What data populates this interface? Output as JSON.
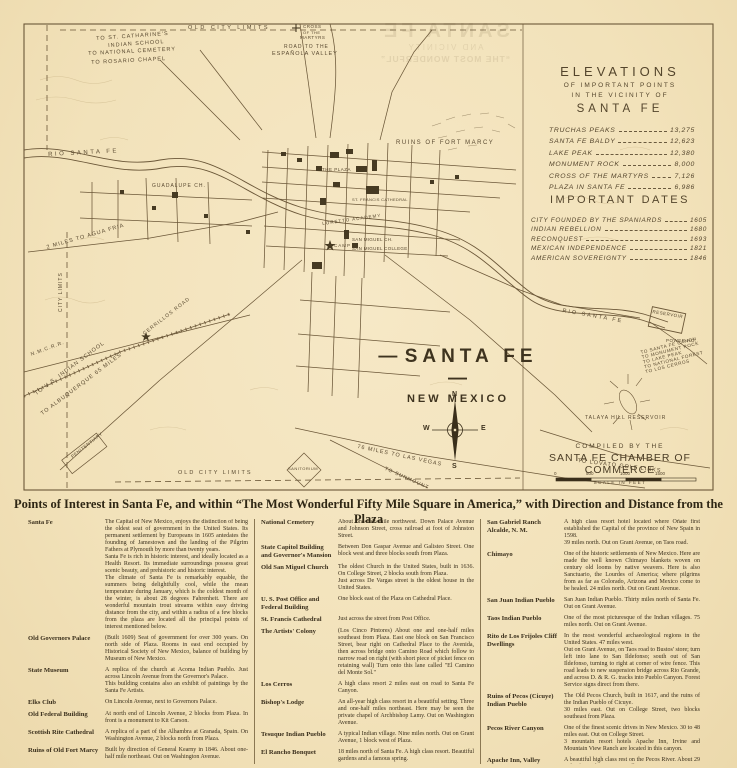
{
  "map": {
    "title": "SANTA FE",
    "subtitle": "NEW MEXICO",
    "compiled_by_line1": "COMPILED BY THE",
    "compiled_by_line2": "SANTA FE CHAMBER OF COMMERCE",
    "scale_label": "SCALE IN FEET",
    "scale_ticks": [
      "0",
      "500",
      "1000",
      "1500"
    ],
    "compass": {
      "n": "N",
      "s": "S",
      "e": "E",
      "w": "W"
    },
    "labels": [
      {
        "text": "OLD CITY LIMITS"
      },
      {
        "text": "TO ST. CATHARINE'S"
      },
      {
        "text": "INDIAN SCHOOL"
      },
      {
        "text": "TO NATIONAL CEMETERY"
      },
      {
        "text": "TO ROSARIO CHAPEL"
      },
      {
        "text": "ROAD TO THE"
      },
      {
        "text": "ESPAÑOLA VALLEY"
      },
      {
        "text": "CROSS"
      },
      {
        "text": "OF THE"
      },
      {
        "text": "MARTYRS"
      },
      {
        "text": "RUINS OF FORT MARCY"
      },
      {
        "text": "RIO SANTA FE"
      },
      {
        "text": "RIO SANTA FE"
      },
      {
        "text": "GUADALUPE CH."
      },
      {
        "text": "THE PLAZA"
      },
      {
        "text": "ST. FRANCIS CATHEDRAL"
      },
      {
        "text": "SAN MIGUEL CH."
      },
      {
        "text": "SAN MIGUEL COLLEGE"
      },
      {
        "text": "LORETTO ACADEMY"
      },
      {
        "text": "2 MILES TO AGUA FRIA"
      },
      {
        "text": "CITY LIMITS"
      },
      {
        "text": "N.M.C.R.R."
      },
      {
        "text": "TO U.S. INDIAN SCHOOL"
      },
      {
        "text": "TO ALBUQUERQUE 65 MILES"
      },
      {
        "text": "CERRILLOS ROAD"
      },
      {
        "text": "PENITENTIARY"
      },
      {
        "text": "TO LOVATO GOLF LINKS"
      },
      {
        "text": "OLD CITY LIMITS"
      },
      {
        "text": "76 MILES TO LAS VEGAS"
      },
      {
        "text": "TO SUNMOUNT"
      },
      {
        "text": "SANITORIUM"
      },
      {
        "text": "RESERVOIR"
      },
      {
        "text": "POWER HO."
      },
      {
        "text": "TO SANTA FE CANON"
      },
      {
        "text": "TO MONUMENT ROCK"
      },
      {
        "text": "TO LAKE PEAK"
      },
      {
        "text": "TO NATIONAL FOREST"
      },
      {
        "text": "TO LOS CERROS"
      },
      {
        "text": "TALAYA HILL RESERVOIR"
      },
      {
        "text": "CAMP"
      }
    ],
    "ink_color": "#5a4a31",
    "paper_color": "#f2e2ba"
  },
  "bleedthrough": {
    "line1": "SANTA FE",
    "line2": "AND VICINITY",
    "line3": "“THE MOST WONDERFUL”"
  },
  "elevations": {
    "title": "ELEVATIONS",
    "subtitle1": "OF IMPORTANT POINTS",
    "subtitle2": "IN THE VICINITY OF",
    "subtitle3": "SANTA FE",
    "items": [
      {
        "name": "TRUCHAS PEAKS",
        "value": "13,275"
      },
      {
        "name": "SANTA FE BALDY",
        "value": "12,623"
      },
      {
        "name": "LAKE PEAK",
        "value": "12,380"
      },
      {
        "name": "MONUMENT ROCK",
        "value": "8,000"
      },
      {
        "name": "CROSS OF THE MARTYRS",
        "value": "7,126"
      },
      {
        "name": "PLAZA IN SANTA FE",
        "value": "6,986"
      }
    ]
  },
  "dates": {
    "title": "IMPORTANT DATES",
    "items": [
      {
        "name": "CITY FOUNDED BY THE SPANIARDS",
        "value": "1605"
      },
      {
        "name": "INDIAN REBELLION",
        "value": "1680"
      },
      {
        "name": "RECONQUEST",
        "value": "1693"
      },
      {
        "name": "MEXICAN INDEPENDENCE",
        "value": "1821"
      },
      {
        "name": "AMERICAN SOVEREIGNTY",
        "value": "1846"
      }
    ]
  },
  "poi": {
    "header": "Points of Interest in Santa Fe, and within “The Most Wonderful Fifty Mile Square in America,” with Direction and Distance from the Plaza",
    "columns": [
      {
        "entries": [
          {
            "term": "Santa Fe",
            "desc": "The Capital of New Mexico, enjoys the distinction of being the oldest seat of government in the United States. Its permanent settlement by Europeans in 1605 antedates the founding of Jamestown and the landing of the Pilgrim Fathers at Plymouth by more than twenty years.\nSanta Fe is rich in historic interest, and ideally located as a Health Resort. Its immediate surroundings possess great scenic beauty, and prehistoric and historic interest.\nThe climate of Santa Fe is remarkably equable, the summers being delightfully cool, while the mean temperature during January, which is the coldest month of the winter, is about 28 degrees Fahrenheit. There are wonderful mountain trout streams within easy driving distance from the city, and within a radius of a few blocks from the plaza are located all the principal points of interest mentioned below."
          },
          {
            "term": "Old Governors Palace",
            "desc": "(Built 1609) Seat of government for over 300 years. On north side of Plaza. Rooms in east end occupied by Historical Society of New Mexico, balance of building by Museum of New Mexico."
          },
          {
            "term": "State Museum",
            "desc": "A replica of the church at Acoma Indian Pueblo. Just across Lincoln Avenue from the Governor's Palace.\nThis building contains also an exhibit of paintings by the Santa Fe Artists."
          },
          {
            "term": "Elks Club",
            "desc": "On Lincoln Avenue, next to Governors Palace."
          },
          {
            "term": "Old Federal Building",
            "desc": "At north end of Lincoln Avenue, 2 blocks from Plaza. In front is a monument to Kit Carson."
          },
          {
            "term": "Scottish Rite Cathedral",
            "desc": "A replica of a part of the Alhambra at Granada, Spain. On Washington Avenue, 2 blocks north from Plaza."
          },
          {
            "term": "Ruins of Old Fort Marcy",
            "desc": "Built by direction of General Kearny in 1846. About one-half mile northeast. Out on Washington Avenue."
          }
        ]
      },
      {
        "entries": [
          {
            "term": "National Cemetery",
            "desc": "About one-half mile northwest. Down Palace Avenue and Johnson Street, cross railroad at foot of Johnston Street."
          },
          {
            "term": "State Capitol Building and Governor's Mansion",
            "desc": "Between Don Gaspar Avenue and Galisteo Street. One block west and three blocks south from Plaza."
          },
          {
            "term": "Old San Miguel Church",
            "desc": "The oldest Church in the United States, built in 1636. On College Street, 2 blocks south from Plaza.\nJust across De Vargas street is the oldest house in the United States."
          },
          {
            "term": "U. S. Post Office and Federal Building",
            "desc": "One block east of the Plaza on Cathedral Place."
          },
          {
            "term": "St. Francis Cathedral",
            "desc": "Just across the street from Post Office."
          },
          {
            "term": "The Artists' Colony",
            "desc": "(Los Cinco Pintores) About one and one-half miles southeast from Plaza. East one block on San Francisco Street, bear right on Cathedral Place to the Avenida, then across bridge onto Camino Road which follow to narrow road on right (with short piece of picket fence on retaining wall) Turn onto this lane called \"El Camino del Monte Sol.\""
          },
          {
            "term": "Los Cerros",
            "desc": "A high class resort 2 miles east on road to Santa Fe Canyon."
          },
          {
            "term": "Bishop's Lodge",
            "desc": "An all-year high class resort in a beautiful setting. Three and one-half miles northeast. Here may be seen the private chapel of Archbishop Lamy. Out on Washington Avenue."
          },
          {
            "term": "Tesuque Indian Pueblo",
            "desc": "A typical Indian village. Nine miles north. Out on Grant Avenue, 1 block west of Plaza."
          },
          {
            "term": "El Rancho Bonquet",
            "desc": "18 miles north of Santa Fe. A high class resort. Beautiful gardens and a famous spring."
          },
          {
            "term": "San Ildefonso Indian Pueblo",
            "desc": "Here lives Maria, the artistic pottery maker. Twenty-seven miles northwest. Out on Grant Avenue."
          }
        ]
      },
      {
        "entries": [
          {
            "term": "San Gabriel Ranch Alcalde, N. M.",
            "desc": "A high class resort hotel located where Oñate first established the Capital of the province of New Spain in 1598.\n39 miles north. Out on Grant Avenue, on Taos road."
          },
          {
            "term": "Chimayo",
            "desc": "One of the historic settlements of New Mexico. Here are made the well known Chimayo blankets woven on century old looms by native weavers. Here is also Sanctuario, the Lourdes of America; where pilgrims from as far as Colorado, Arizona and Mexico come to be healed. 24 miles north. Out on Grant Avenue."
          },
          {
            "term": "San Juan Indian Pueblo",
            "desc": "San Juan Indian Pueblo. Thirty miles north of Santa Fe. Out on Grant Avenue."
          },
          {
            "term": "Taos Indian Pueblo",
            "desc": "One of the most picturesque of the Indian villages. 75 miles north. Out on Grant Avenue."
          },
          {
            "term": "Rito de Los Frijoles Cliff Dwellings",
            "desc": "In the most wonderful archaeological regions in the United States. 47 miles west.\nOut on Grant Avenue, on Taos road to Bustos' store; turn left into lane to San Ildefonso; south out of San Ildefonso, turning to right at corner of wire fence. This road leads to new suspension bridge across Rio Grande, and across D. & R. G. tracks into Pueblo Canyon. Forest Service signs direct from there."
          },
          {
            "term": "Ruins of Pecos (Cicuye) Indian Pueblo",
            "desc": "The Old Pecos Church, built in 1617, and the ruins of the Indian Pueblo of Cicuye.\n30 miles east. Out on College Street, two blocks southeast from Plaza."
          },
          {
            "term": "Pecos River Canyon",
            "desc": "One of the finest scenic drives in New Mexico. 30 to 48 miles east. Out on College Street.\n3 mountain resort hotels Apache Inn, Irvine and Mountain View Ranch are located in this canyon."
          },
          {
            "term": "Apache Inn, Valley Ranch, N. M.",
            "desc": "A beautiful high class rest on the Pecos River. About 29 miles from Plaza, out on College Street."
          },
          {
            "term": "Petrified Forest near Cerrillos, N. M.",
            "desc": "Some very good specimens of petrified trees may be seen here. 26 miles south."
          }
        ]
      }
    ]
  }
}
